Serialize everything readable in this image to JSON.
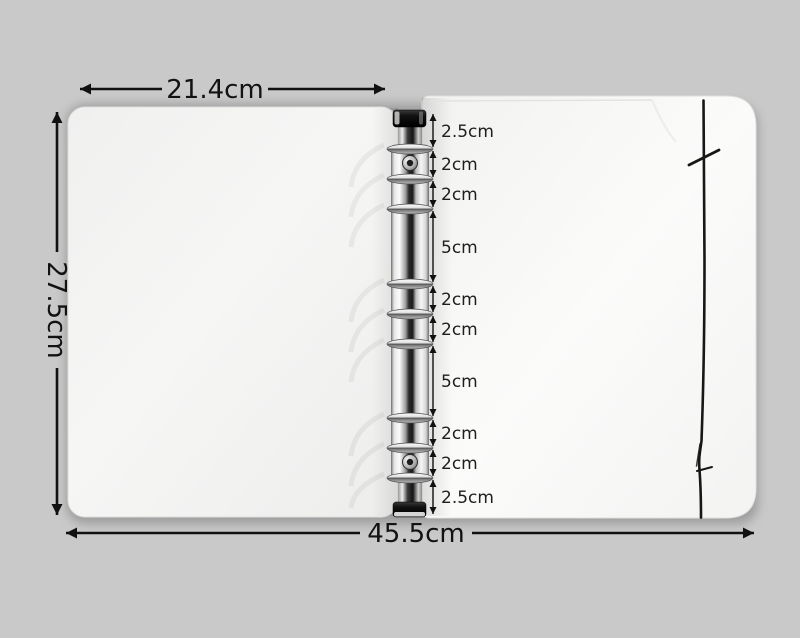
{
  "measurements": {
    "page_width_label": "21.4cm",
    "cover_height_label": "27.5cm",
    "total_width_label": "45.5cm"
  },
  "spine_segments": [
    "2.5cm",
    "2cm",
    "2cm",
    "5cm",
    "2cm",
    "2cm",
    "5cm",
    "2cm",
    "2cm",
    "2.5cm"
  ],
  "colors": {
    "background": "#c9c9c9",
    "cover_white": "#f4f4f3",
    "annotation_black": "#111111",
    "chrome_light": "#f6f6f6",
    "chrome_dark": "#1c1c1c",
    "elastic_cord": "#171717"
  }
}
